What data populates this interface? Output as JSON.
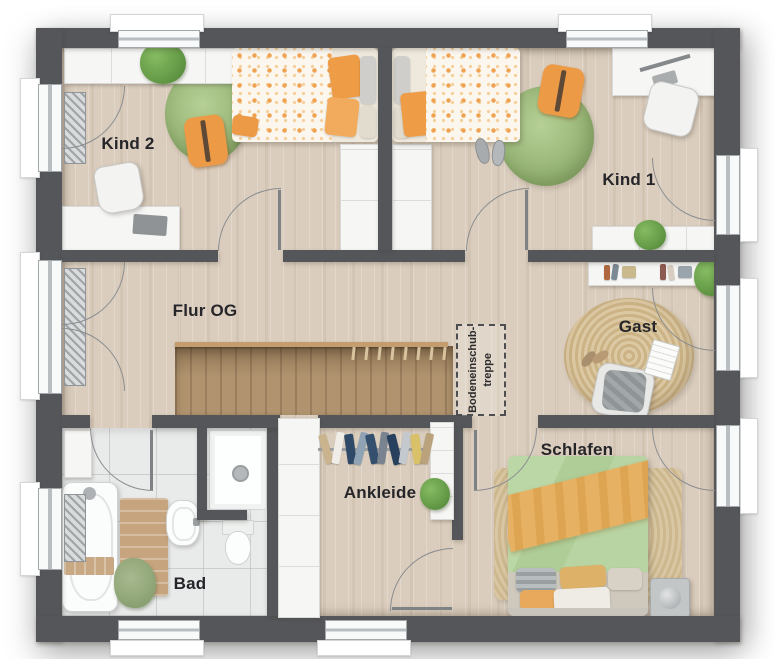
{
  "page": {
    "type": "floor-plan",
    "background": "#ffffff"
  },
  "rooms": {
    "kind2": {
      "label": "Kind 2"
    },
    "kind1": {
      "label": "Kind 1"
    },
    "flur": {
      "label": "Flur OG"
    },
    "gast": {
      "label": "Gast"
    },
    "schlafen": {
      "label": "Schlafen"
    },
    "ankleide": {
      "label": "Ankleide"
    },
    "bad": {
      "label": "Bad"
    }
  },
  "stair_annotation": {
    "line1": "Bodeneinschub-",
    "line2": "treppe"
  },
  "colors": {
    "wall": "#54565a",
    "floor_wood": "#dacdbd",
    "stair_wood": "#b1946f",
    "bath_tile": "#e9eaea",
    "rug_green": "#a5c187",
    "rug_jute": "#d3bd95",
    "accent_orange": "#ed9a46",
    "duvet_green": "#b5d19e",
    "blanket_orange": "#e7b163",
    "furniture_white": "#f6f6f5",
    "plant_green": "#6aa04a",
    "railing_wood": "#c49d6e"
  },
  "furniture": {
    "kind2": [
      "wardrobe-top",
      "plant",
      "single-bed",
      "round-rug",
      "floor-cushion",
      "desk",
      "desk-chair",
      "closet"
    ],
    "kind1": [
      "closet",
      "single-bed",
      "round-rug",
      "floor-cushion",
      "slippers",
      "desk",
      "desk-chair",
      "lowboard",
      "plant"
    ],
    "gast": [
      "sideboard",
      "books",
      "plant",
      "jute-rug",
      "armchair",
      "book",
      "slippers"
    ],
    "schlafen": [
      "double-bed",
      "rug",
      "nightstand"
    ],
    "ankleide": [
      "wardrobe",
      "clothes-rail",
      "shelf",
      "plant"
    ],
    "bad": [
      "cabinet",
      "bathtub",
      "bath-mat",
      "towels",
      "sink",
      "shower",
      "toilet"
    ]
  }
}
